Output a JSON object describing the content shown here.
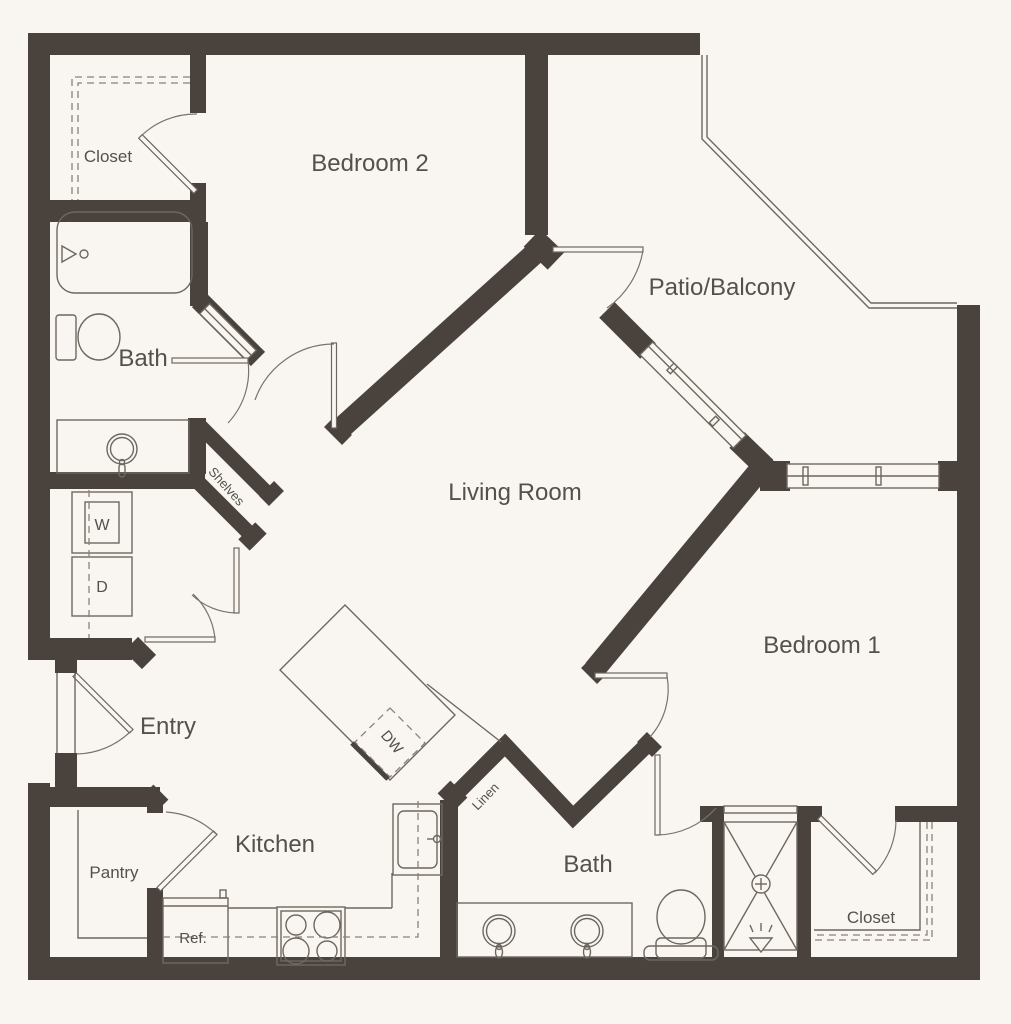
{
  "title": "Two Bedroom Apartment Floor Plan",
  "colors": {
    "background": "#f9f6f1",
    "wall": "#4a433d",
    "fixture_line": "#6e675f",
    "dashed_line": "#8a8179",
    "text": "#56504a"
  },
  "rooms": [
    {
      "id": "bedroom2",
      "label": "Bedroom 2"
    },
    {
      "id": "closet_top",
      "label": "Closet"
    },
    {
      "id": "bath_top",
      "label": "Bath"
    },
    {
      "id": "patio",
      "label": "Patio/Balcony"
    },
    {
      "id": "living",
      "label": "Living Room"
    },
    {
      "id": "bedroom1",
      "label": "Bedroom 1"
    },
    {
      "id": "entry",
      "label": "Entry"
    },
    {
      "id": "kitchen",
      "label": "Kitchen"
    },
    {
      "id": "pantry",
      "label": "Pantry"
    },
    {
      "id": "bath_bottom",
      "label": "Bath"
    },
    {
      "id": "closet_bottom",
      "label": "Closet"
    }
  ],
  "fixtures": {
    "washer": "W",
    "dryer": "D",
    "dishwasher": "DW",
    "refrigerator": "Ref.",
    "shelves": "Shelves",
    "linen": "Linen"
  }
}
